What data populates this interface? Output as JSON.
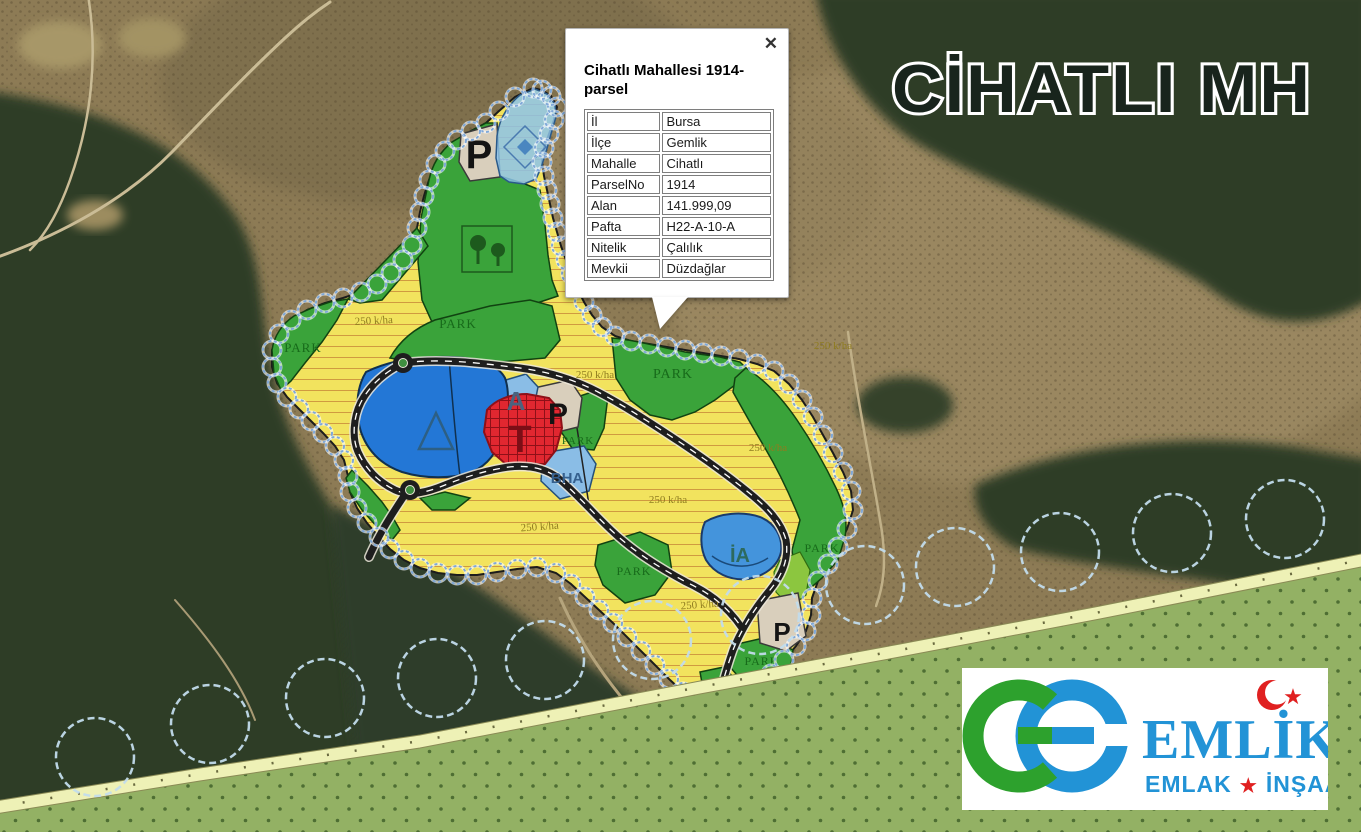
{
  "overlay_title": "CİHATLI MH",
  "popup": {
    "title": "Cihatlı Mahallesi 1914-parsel",
    "close_label": "✕",
    "fields": [
      {
        "label": "İl",
        "value": "Bursa"
      },
      {
        "label": "İlçe",
        "value": "Gemlik"
      },
      {
        "label": "Mahalle",
        "value": "Cihatlı"
      },
      {
        "label": "ParselNo",
        "value": "1914"
      },
      {
        "label": "Alan",
        "value": "141.999,09"
      },
      {
        "label": "Pafta",
        "value": "H22-A-10-A"
      },
      {
        "label": "Nitelik",
        "value": "Çalılık"
      },
      {
        "label": "Mevkii",
        "value": "Düzdağlar"
      }
    ]
  },
  "logo": {
    "monogram": "GE",
    "brand": "EMLİK",
    "sub_left": "EMLAK",
    "star": "★",
    "sub_right": "İNŞAAT"
  },
  "colors": {
    "zone_residential": "#f2e35e",
    "zone_park": "#3aa33a",
    "zone_water": "#2377d6",
    "zone_trade_T": "#e12730",
    "zone_social_blue": "#8abde6",
    "zone_facility_beige": "#d9cfbc",
    "band_agriculture": "#93b164",
    "road": "#1e1e1e",
    "boundary_marker": "#7fa8d8",
    "logo_green": "#2da12d",
    "logo_blue": "#2293d6",
    "logo_red": "#e02020"
  },
  "map_labels": [
    {
      "text": "PARK",
      "x": 303,
      "y": 352,
      "size": 13,
      "color": "#176a1a",
      "serif": true,
      "ls": 1
    },
    {
      "text": "PARK",
      "x": 458,
      "y": 328,
      "size": 13,
      "color": "#176a1a",
      "serif": true,
      "ls": 1
    },
    {
      "text": "PARK",
      "x": 673,
      "y": 378,
      "size": 14,
      "color": "#176a1a",
      "serif": true,
      "ls": 1
    },
    {
      "text": "PARK",
      "x": 578,
      "y": 444,
      "size": 11,
      "color": "#176a1a",
      "serif": true,
      "ls": 1
    },
    {
      "text": "PARK",
      "x": 634,
      "y": 575,
      "size": 12,
      "color": "#176a1a",
      "serif": true,
      "ls": 1
    },
    {
      "text": "PARK",
      "x": 762,
      "y": 665,
      "size": 12,
      "color": "#176a1a",
      "serif": true,
      "ls": 1
    },
    {
      "text": "PARK",
      "x": 822,
      "y": 552,
      "size": 12,
      "color": "#176a1a",
      "serif": true,
      "ls": 1
    },
    {
      "text": "250 k/ha",
      "x": 374,
      "y": 324,
      "size": 11,
      "color": "#8f7c20",
      "serif": true,
      "rot": -3
    },
    {
      "text": "250 k/ha",
      "x": 595,
      "y": 378,
      "size": 11,
      "color": "#8f7c20",
      "serif": true
    },
    {
      "text": "250 k/ha",
      "x": 768,
      "y": 451,
      "size": 11,
      "color": "#8f7c20",
      "serif": true
    },
    {
      "text": "250 k/ha",
      "x": 668,
      "y": 503,
      "size": 11,
      "color": "#8f7c20",
      "serif": true
    },
    {
      "text": "250 k/ha",
      "x": 540,
      "y": 530,
      "size": 11,
      "color": "#8f7c20",
      "serif": true,
      "rot": -4
    },
    {
      "text": "250 k/ha",
      "x": 700,
      "y": 608,
      "size": 11,
      "color": "#8f7c20",
      "serif": true,
      "rot": -4
    },
    {
      "text": "250 k/ha",
      "x": 833,
      "y": 349,
      "size": 11,
      "color": "#8f7c20",
      "serif": true
    },
    {
      "text": "P",
      "x": 479,
      "y": 168,
      "size": 40,
      "color": "#141414",
      "bold": true
    },
    {
      "text": "P",
      "x": 558,
      "y": 424,
      "size": 30,
      "color": "#141414",
      "bold": true
    },
    {
      "text": "P",
      "x": 782,
      "y": 641,
      "size": 26,
      "color": "#141414",
      "bold": true
    },
    {
      "text": "T",
      "x": 520,
      "y": 452,
      "size": 38,
      "color": "#7c0e16",
      "bold": true
    },
    {
      "text": "A",
      "x": 516,
      "y": 410,
      "size": 26,
      "color": "#4a637f",
      "bold": true
    },
    {
      "text": "BHA",
      "x": 567,
      "y": 483,
      "size": 15,
      "color": "#35608e",
      "bold": true
    },
    {
      "text": "İA",
      "x": 740,
      "y": 562,
      "size": 20,
      "color": "#2d6a5e",
      "bold": true
    }
  ]
}
